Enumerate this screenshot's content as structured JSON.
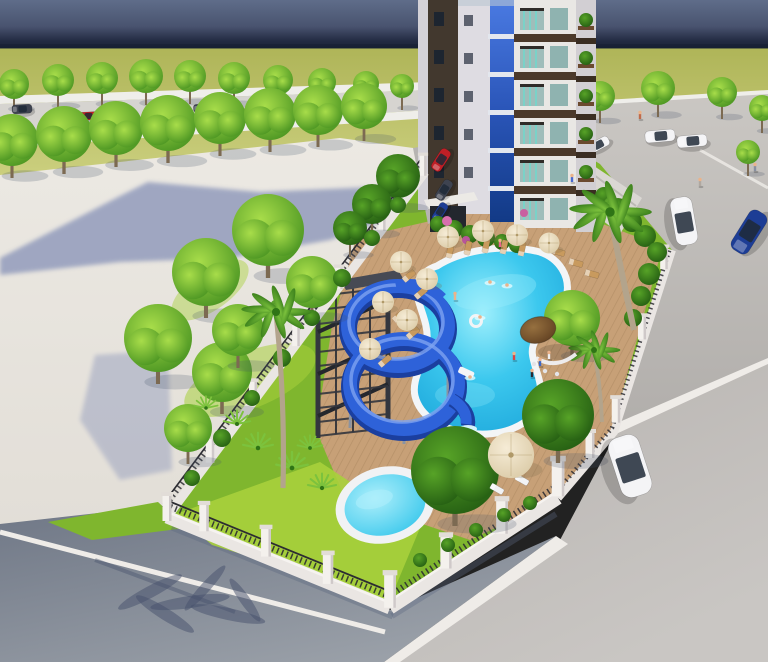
{
  "scene": {
    "title": "aerial 3D architectural rendering of residential tower with pool, blue spiral waterslide, palm garden, fenced compound, roads and cars",
    "type": "architectural-render"
  },
  "palette": {
    "sky_top": "#5f6d8a",
    "sky_mid": "#49536f",
    "sky_deep": "#232b43",
    "sky_low": "#1b2336",
    "field_top": "#aeb457",
    "field_bottom": "#dadd92",
    "sidewalk": "#efeeea",
    "road_street": "#d6d4d0",
    "plaza_top": "#ece9e3",
    "plaza_bottom": "#e2ded7",
    "plaza_shadow": "#8d97ba",
    "road_r_top": "#cac7c3",
    "road_r_bottom": "#b1aeab",
    "pavement": "#b7b3b0",
    "pavement_light": "#c9c6c3",
    "asphalt_dark": "#6f7786",
    "asphalt_light": "#9ba1a9",
    "stripe": "#efece8",
    "lawn": "#7fb62e",
    "lawn_bright": "#a8d03c",
    "tree_light": "#a8dd4a",
    "tree_dark": "#3f8c1d",
    "dtree_light": "#57a327",
    "dtree_dark": "#1e5510",
    "palm_light": "#7cc23d",
    "palm_dark": "#2f7416",
    "palm_trunk": "#b3a48c",
    "trunk": "#7c6a52",
    "deck": "#c7a077",
    "plank_line": "#5a3c1c",
    "pool_rim": "#f3f5f7",
    "water_light": "#9eeffc",
    "water_mid": "#3cc8ee",
    "water_deep": "#18a2d8",
    "kids_light": "#aeeffb",
    "kids_mid": "#2cc3ea",
    "slide": "#2e62d9",
    "slide_dark": "#1b3f9f",
    "slide_light": "#7da3f0",
    "stairs": "#33363e",
    "stairs_dark": "#24272d",
    "fence": "#eae6e3",
    "fence_hi": "#f6f3f0",
    "railing": "#2c2c32",
    "pillar": "#f4f1ed",
    "pillar_cap": "#e2ddd8",
    "pillar_shade": "#cfc9c9",
    "glass_top": "#4a7ae2",
    "glass_mid": "#2a55b8",
    "glass_bottom": "#123a86",
    "bld_edge": "#d4d2d8",
    "bld_dark": "#42382e",
    "bld_col": "#dedce2",
    "bld_main": "#e9e7e4",
    "bld_balc": "#d2cfd3",
    "band": "#4b392a",
    "band_balc": "#3a2d22",
    "win_dark": "#1d2530",
    "win_bg": "#9fbdba",
    "curtain": "#7ad2c8",
    "terrace": "#dad7d3",
    "brick": "#aa8160",
    "parking_pad": "#b7b4b2",
    "umb_light": "#f6ecd6",
    "umb_dark": "#d7c6a0",
    "lounger": "#c89a5e",
    "lounger_white": "#f2f3f5",
    "thatch_light": "#96703f",
    "thatch_dark": "#59391d",
    "car_white": "#f4f4f6",
    "car_red": "#bf1f26",
    "car_blue": "#1d3d95",
    "car_dark": "#3e4350",
    "car_glass": "#1f2937",
    "skin": "#eab38b",
    "shadow_cool": "#45506b",
    "shadow_fence": "#5c6880"
  },
  "objects": {
    "street_trees_back": [
      [
        14,
        84,
        15
      ],
      [
        58,
        80,
        16
      ],
      [
        102,
        78,
        16
      ],
      [
        146,
        76,
        17
      ],
      [
        190,
        76,
        16
      ],
      [
        234,
        78,
        16
      ],
      [
        278,
        80,
        15
      ],
      [
        322,
        82,
        14
      ],
      [
        366,
        84,
        13
      ],
      [
        402,
        86,
        12
      ]
    ],
    "street_trees_front": [
      [
        12,
        140,
        26
      ],
      [
        64,
        134,
        28
      ],
      [
        116,
        128,
        27
      ],
      [
        168,
        123,
        28
      ],
      [
        220,
        118,
        26
      ],
      [
        270,
        114,
        26
      ],
      [
        318,
        110,
        25
      ],
      [
        364,
        106,
        23
      ]
    ],
    "right_road_trees": [
      [
        600,
        96,
        15
      ],
      [
        658,
        88,
        17
      ],
      [
        722,
        92,
        15
      ],
      [
        762,
        108,
        13
      ],
      [
        748,
        152,
        12
      ]
    ],
    "garden_trees": [
      [
        268,
        230,
        36
      ],
      [
        206,
        272,
        34
      ],
      [
        158,
        338,
        34
      ],
      [
        222,
        372,
        30
      ],
      [
        312,
        282,
        26
      ],
      [
        188,
        428,
        24
      ],
      [
        238,
        330,
        26
      ],
      [
        572,
        318,
        28
      ]
    ],
    "dark_trees": [
      [
        398,
        176,
        22
      ],
      [
        372,
        204,
        20
      ],
      [
        350,
        228,
        17
      ],
      [
        455,
        470,
        44
      ],
      [
        558,
        415,
        36
      ]
    ],
    "hedges": [
      [
        192,
        478,
        8
      ],
      [
        222,
        438,
        9
      ],
      [
        252,
        398,
        8
      ],
      [
        282,
        358,
        9
      ],
      [
        312,
        318,
        8
      ],
      [
        342,
        278,
        9
      ],
      [
        372,
        238,
        8
      ],
      [
        398,
        205,
        8
      ],
      [
        438,
        224,
        8
      ],
      [
        454,
        229,
        9
      ],
      [
        470,
        234,
        9
      ],
      [
        486,
        238,
        9
      ],
      [
        502,
        242,
        8
      ],
      [
        517,
        245,
        8
      ],
      [
        604,
        196,
        9
      ],
      [
        618,
        208,
        10
      ],
      [
        632,
        222,
        10
      ],
      [
        645,
        236,
        11
      ],
      [
        657,
        252,
        10
      ],
      [
        649,
        274,
        11
      ],
      [
        641,
        296,
        10
      ],
      [
        633,
        318,
        9
      ],
      [
        420,
        560,
        7
      ],
      [
        448,
        545,
        7
      ],
      [
        476,
        530,
        7
      ],
      [
        504,
        515,
        7
      ],
      [
        530,
        503,
        7
      ]
    ],
    "flowers": [
      [
        447,
        221,
        5,
        "#d86fae"
      ],
      [
        524,
        213,
        4,
        "#c95fa0"
      ],
      [
        466,
        240,
        4,
        "#b8559a"
      ]
    ],
    "palms": [
      [
        610,
        212,
        634,
        330,
        1.35
      ],
      [
        594,
        350,
        602,
        422,
        0.85
      ],
      [
        276,
        312,
        283,
        488,
        1.15
      ]
    ],
    "fan_palms": [
      [
        237,
        424,
        0.8
      ],
      [
        258,
        448,
        0.9
      ],
      [
        292,
        468,
        0.95
      ],
      [
        322,
        488,
        0.85
      ],
      [
        206,
        408,
        0.7
      ],
      [
        310,
        448,
        0.75
      ]
    ],
    "umbrellas": [
      [
        448,
        237,
        1
      ],
      [
        483,
        231,
        1
      ],
      [
        517,
        235,
        1
      ],
      [
        549,
        243,
        0.95
      ],
      [
        401,
        262,
        1
      ],
      [
        427,
        279,
        1
      ],
      [
        383,
        302,
        1
      ],
      [
        407,
        320,
        1
      ],
      [
        370,
        349,
        1
      ],
      [
        511,
        455,
        2.1
      ]
    ],
    "loungers": [
      [
        450,
        251,
        -78,
        0
      ],
      [
        468,
        248,
        -78,
        0
      ],
      [
        486,
        246,
        -78,
        0
      ],
      [
        504,
        247,
        -78,
        0
      ],
      [
        522,
        249,
        -78,
        0
      ],
      [
        409,
        276,
        -40,
        0
      ],
      [
        421,
        293,
        -40,
        0
      ],
      [
        399,
        316,
        -40,
        0
      ],
      [
        413,
        333,
        -40,
        0
      ],
      [
        385,
        361,
        -40,
        0
      ],
      [
        558,
        252,
        15,
        0
      ],
      [
        576,
        263,
        15,
        0
      ],
      [
        592,
        274,
        15,
        0
      ],
      [
        497,
        489,
        30,
        1
      ],
      [
        522,
        480,
        30,
        1
      ]
    ],
    "cars": [
      [
        22,
        109,
        20,
        9,
        -3,
        "car_dark",
        "street"
      ],
      [
        88,
        116,
        19,
        8,
        -3,
        "car_red",
        "street"
      ],
      [
        203,
        108,
        19,
        8,
        -3,
        "car_dark",
        "street"
      ],
      [
        247,
        112,
        17,
        7,
        -3,
        "car_red",
        "street"
      ],
      [
        598,
        145,
        24,
        10,
        -28,
        "car_white",
        "road"
      ],
      [
        660,
        136,
        30,
        12,
        -5,
        "car_white",
        "road"
      ],
      [
        692,
        141,
        30,
        12,
        -5,
        "car_white",
        "road"
      ],
      [
        684,
        221,
        48,
        22,
        80,
        "car_white",
        "road"
      ],
      [
        749,
        232,
        46,
        20,
        -58,
        "car_blue",
        "road"
      ],
      [
        441,
        160,
        24,
        11,
        -57,
        "car_red",
        "lot"
      ],
      [
        444,
        190,
        22,
        10,
        -57,
        "car_dark",
        "lot"
      ],
      [
        440,
        212,
        20,
        9,
        -57,
        "car_blue",
        "lot"
      ],
      [
        630,
        466,
        62,
        32,
        72,
        "car_white",
        "ext"
      ]
    ],
    "people": [
      [
        500,
        247,
        "#e8628f"
      ],
      [
        514,
        360,
        "#d84545"
      ],
      [
        540,
        366,
        "#3a66c8"
      ],
      [
        549,
        359,
        "#f0f0f2"
      ],
      [
        532,
        377,
        "#2a2a33"
      ],
      [
        572,
        182,
        "#4a6ad0"
      ],
      [
        640,
        119,
        "#c06a4a"
      ],
      [
        700,
        186,
        "#b0a8a0"
      ],
      [
        755,
        171,
        "#8890a0"
      ],
      [
        455,
        300,
        "#e8b48e"
      ]
    ],
    "swimmers": [
      [
        490,
        283
      ],
      [
        507,
        286
      ],
      [
        480,
        318
      ],
      [
        470,
        378
      ]
    ],
    "fence_pillars": [
      [
        167,
        495,
        1.0
      ],
      [
        210,
        438,
        0.95
      ],
      [
        253,
        381,
        0.9
      ],
      [
        296,
        324,
        0.85
      ],
      [
        339,
        267,
        0.85
      ],
      [
        382,
        210,
        0.8
      ],
      [
        423,
        155,
        0.8
      ],
      [
        204,
        504,
        1.05
      ],
      [
        266,
        528,
        1.1
      ],
      [
        328,
        554,
        1.15
      ],
      [
        390,
        574,
        1.3
      ],
      [
        446,
        536,
        1.25
      ],
      [
        502,
        500,
        1.3
      ],
      [
        558,
        460,
        1.4
      ],
      [
        590,
        432,
        1.0
      ],
      [
        616,
        398,
        0.95
      ],
      [
        642,
        316,
        0.9
      ],
      [
        664,
        247,
        0.85
      ]
    ],
    "palm_shadow": [
      [
        150,
        592,
        36,
        6,
        -28
      ],
      [
        190,
        602,
        40,
        6,
        -8
      ],
      [
        228,
        614,
        38,
        6,
        12
      ],
      [
        165,
        614,
        34,
        6,
        32
      ],
      [
        205,
        588,
        30,
        5,
        -48
      ],
      [
        245,
        600,
        26,
        5,
        55
      ]
    ]
  }
}
